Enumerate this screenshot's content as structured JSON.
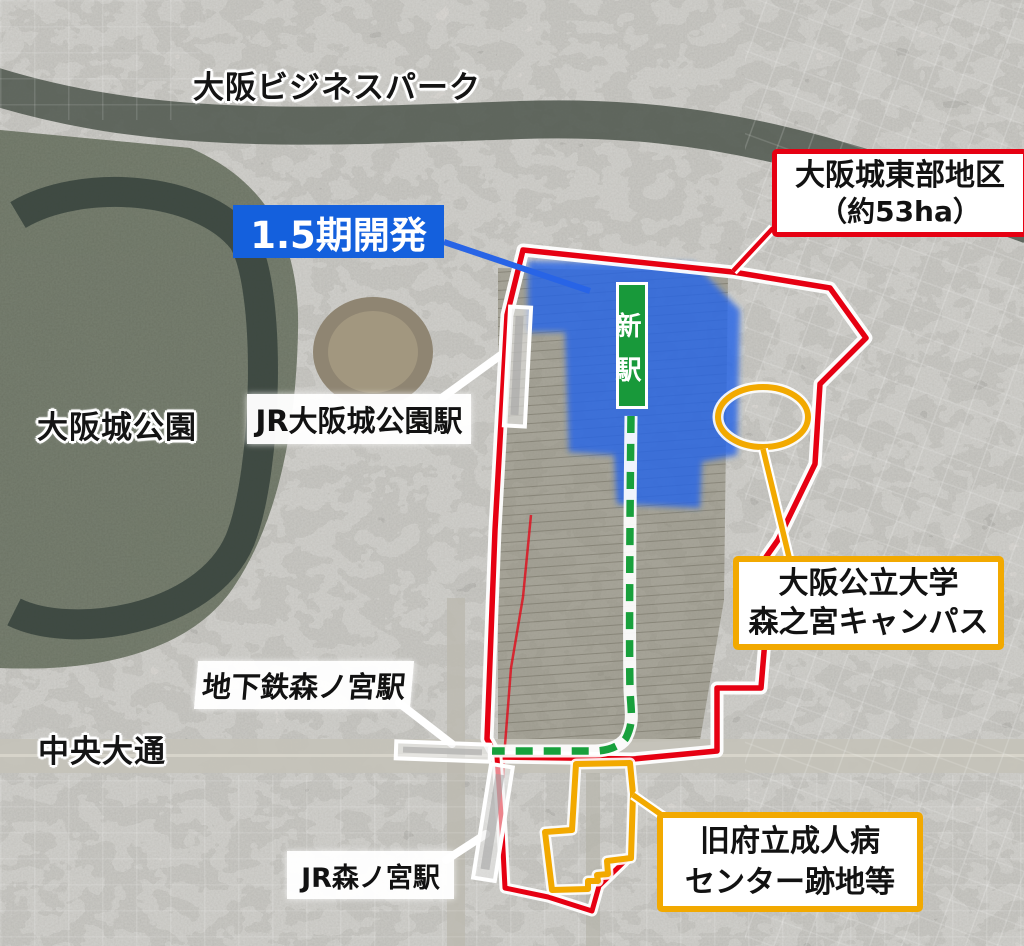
{
  "map_labels": {
    "osaka_business_park": "大阪ビジネスパーク",
    "osaka_castle_park": "大阪城公園",
    "chuo_odori": "中央大通"
  },
  "callouts": {
    "district": {
      "line1": "大阪城東部地区",
      "line2": "（約53ha）",
      "border_color": "#e60012"
    },
    "phase15": {
      "label": "1.5期開発",
      "bg_color": "#1460dd"
    },
    "new_station": {
      "label": "新駅",
      "bg_color": "#18993a"
    },
    "campus": {
      "line1": "大阪公立大学",
      "line2": "森之宮キャンパス",
      "border_color": "#f2a900"
    },
    "hospital_site": {
      "line1": "旧府立成人病",
      "line2": "センター跡地等",
      "border_color": "#f2a900"
    }
  },
  "station_labels": {
    "jr_osakajo_koen": "JR大阪城公園駅",
    "subway_morinomiya": "地下鉄森ノ宮駅",
    "jr_morinomiya": "JR森ノ宮駅"
  },
  "legend_colors": {
    "district_boundary": "#e60012",
    "development_area_overlay": "#2864e6",
    "route_dashed_line": "#18a03c",
    "site_highlight": "#f2a900"
  }
}
